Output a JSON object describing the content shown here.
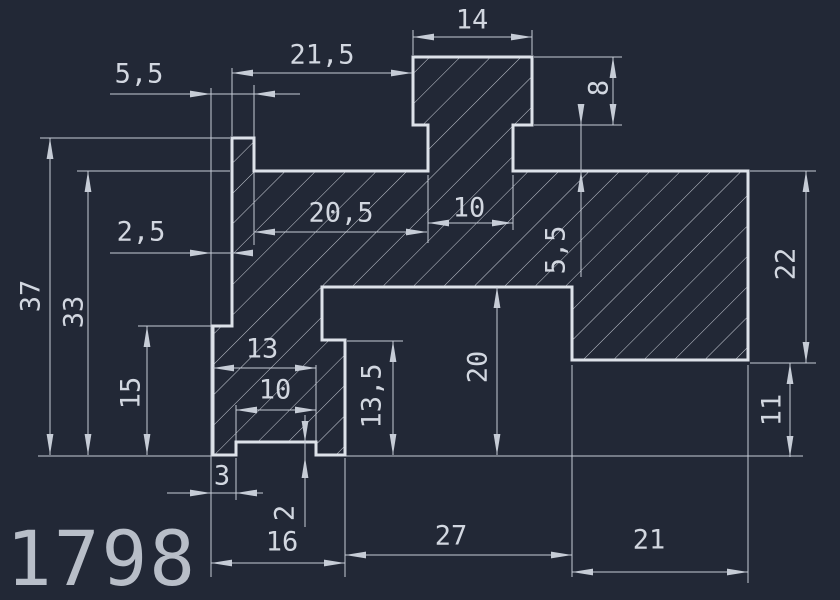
{
  "app": {
    "viewport_label": "CAD model space",
    "background_color": "#222836"
  },
  "style": {
    "outline_color": "#dde2e9",
    "thin_color": "#c6ccd6",
    "hatch_color": "#c9ced7",
    "text_color": "#d2d7e0",
    "number_color": "#b8bec8",
    "outline_width": 3,
    "thin_width": 1,
    "hatch_spacing": 21.5,
    "arrow_len": 21,
    "arrow_halfwidth": 3.4,
    "dim_font_size": 27,
    "number_font_size": 76
  },
  "part": {
    "name": "section-profile",
    "outline": [
      [
        232,
        138
      ],
      [
        254,
        138
      ],
      [
        254,
        171
      ],
      [
        428,
        171
      ],
      [
        428,
        125
      ],
      [
        413,
        125
      ],
      [
        413,
        57
      ],
      [
        532,
        57
      ],
      [
        532,
        125
      ],
      [
        513,
        125
      ],
      [
        513,
        171
      ],
      [
        748,
        171
      ],
      [
        748,
        360
      ],
      [
        572,
        360
      ],
      [
        572,
        287
      ],
      [
        322,
        287
      ],
      [
        322,
        340
      ],
      [
        345,
        340
      ],
      [
        345,
        455
      ],
      [
        316,
        455
      ],
      [
        316,
        442
      ],
      [
        236,
        442
      ],
      [
        236,
        455
      ],
      [
        213,
        455
      ],
      [
        213,
        326
      ],
      [
        232,
        326
      ]
    ]
  },
  "ref_lines": [
    [
      40,
      138,
      230,
      138
    ],
    [
      77,
      171,
      230,
      171
    ],
    [
      138,
      326,
      211,
      326
    ],
    [
      38,
      456,
      211,
      456
    ],
    [
      345,
      456,
      803,
      456
    ],
    [
      211,
      88,
      211,
      577
    ],
    [
      254,
      85,
      254,
      245
    ],
    [
      232,
      68,
      232,
      136
    ],
    [
      413,
      30,
      413,
      55
    ],
    [
      532,
      30,
      532,
      55
    ],
    [
      534,
      57,
      622,
      57
    ],
    [
      534,
      125,
      622,
      125
    ],
    [
      750,
      171,
      816,
      171
    ],
    [
      750,
      363,
      816,
      363
    ],
    [
      428,
      175,
      428,
      243
    ],
    [
      513,
      175,
      513,
      230
    ],
    [
      347,
      341,
      403,
      341
    ],
    [
      316,
      365,
      316,
      442
    ],
    [
      236,
      405,
      236,
      442
    ],
    [
      236,
      458,
      236,
      500
    ],
    [
      345,
      458,
      345,
      577
    ],
    [
      572,
      365,
      572,
      577
    ],
    [
      748,
      365,
      748,
      583
    ]
  ],
  "dimensions": [
    {
      "label": "14",
      "line": [
        413,
        37,
        532,
        37
      ],
      "arrows": [
        [
          413,
          37,
          "-x"
        ],
        [
          532,
          37,
          "+x"
        ]
      ],
      "text": [
        472,
        20,
        0
      ]
    },
    {
      "label": "21,5",
      "line": [
        232,
        73,
        412,
        73
      ],
      "arrows": [
        [
          232,
          73,
          "-x"
        ],
        [
          412,
          73,
          "+x"
        ]
      ],
      "text": [
        322,
        55,
        0
      ]
    },
    {
      "label": "5,5",
      "line": [
        110,
        94,
        300,
        94
      ],
      "arrows": [
        [
          211,
          94,
          "+x"
        ],
        [
          254,
          94,
          "-x"
        ]
      ],
      "text": [
        139,
        74,
        0
      ]
    },
    {
      "label": "2,5",
      "line": [
        110,
        253,
        253,
        253
      ],
      "arrows": [
        [
          211,
          253,
          "+x"
        ],
        [
          232,
          253,
          "-x"
        ]
      ],
      "text": [
        141,
        232,
        0
      ]
    },
    {
      "label": "20,5",
      "line": [
        254,
        232,
        427,
        232
      ],
      "arrows": [
        [
          254,
          232,
          "-x"
        ],
        [
          427,
          232,
          "+x"
        ]
      ],
      "text": [
        341,
        213,
        0
      ]
    },
    {
      "label": "10",
      "line": [
        428,
        223,
        513,
        223
      ],
      "arrows": [
        [
          428,
          223,
          "-x"
        ],
        [
          513,
          223,
          "+x"
        ]
      ],
      "text": [
        469,
        208,
        0
      ]
    },
    {
      "label": "8",
      "line": [
        613,
        57,
        613,
        125
      ],
      "arrows": [
        [
          613,
          57,
          "-y"
        ],
        [
          613,
          125,
          "+y"
        ]
      ],
      "text": [
        599,
        88,
        -90
      ]
    },
    {
      "label": "5,5",
      "line": [
        581,
        105,
        581,
        277
      ],
      "arrows": [
        [
          581,
          125,
          "+y"
        ],
        [
          581,
          171,
          "-y"
        ]
      ],
      "text": [
        556,
        250,
        -90
      ]
    },
    {
      "label": "22",
      "line": [
        806,
        171,
        806,
        363
      ],
      "arrows": [
        [
          806,
          171,
          "-y"
        ],
        [
          806,
          363,
          "+y"
        ]
      ],
      "text": [
        786,
        264,
        -90
      ]
    },
    {
      "label": "37",
      "line": [
        50,
        138,
        50,
        455
      ],
      "arrows": [
        [
          50,
          138,
          "-y"
        ],
        [
          50,
          455,
          "+y"
        ]
      ],
      "text": [
        31,
        296,
        -90
      ]
    },
    {
      "label": "33",
      "line": [
        88,
        171,
        88,
        455
      ],
      "arrows": [
        [
          88,
          171,
          "-y"
        ],
        [
          88,
          455,
          "+y"
        ]
      ],
      "text": [
        74,
        312,
        -90
      ]
    },
    {
      "label": "15",
      "line": [
        147,
        326,
        147,
        455
      ],
      "arrows": [
        [
          147,
          326,
          "-y"
        ],
        [
          147,
          455,
          "+y"
        ]
      ],
      "text": [
        131,
        393,
        -90
      ]
    },
    {
      "label": "13",
      "line": [
        213,
        368,
        316,
        368
      ],
      "arrows": [
        [
          213,
          368,
          "-x"
        ],
        [
          316,
          368,
          "+x"
        ]
      ],
      "text": [
        262,
        349,
        0
      ]
    },
    {
      "label": "10",
      "line": [
        236,
        410,
        316,
        410
      ],
      "arrows": [
        [
          236,
          410,
          "-x"
        ],
        [
          316,
          410,
          "+x"
        ]
      ],
      "text": [
        275,
        390,
        0
      ]
    },
    {
      "label": "13,5",
      "line": [
        393,
        341,
        393,
        455
      ],
      "arrows": [
        [
          393,
          341,
          "-y"
        ],
        [
          393,
          455,
          "+y"
        ]
      ],
      "text": [
        372,
        396,
        -90
      ]
    },
    {
      "label": "20",
      "line": [
        497,
        287,
        497,
        455
      ],
      "arrows": [
        [
          497,
          287,
          "-y"
        ],
        [
          497,
          455,
          "+y"
        ]
      ],
      "text": [
        478,
        367,
        -90
      ]
    },
    {
      "label": "11",
      "line": [
        790,
        363,
        790,
        457
      ],
      "arrows": [
        [
          790,
          363,
          "-y"
        ],
        [
          790,
          457,
          "+y"
        ]
      ],
      "text": [
        772,
        410,
        -90
      ]
    },
    {
      "label": "3",
      "line": [
        167,
        493,
        263,
        493
      ],
      "arrows": [
        [
          211,
          493,
          "+x"
        ],
        [
          236,
          493,
          "-x"
        ]
      ],
      "text": [
        222,
        476,
        0
      ]
    },
    {
      "label": "2",
      "line": [
        305,
        415,
        305,
        527
      ],
      "arrows": [
        [
          305,
          442,
          "+y"
        ],
        [
          305,
          457,
          "-y"
        ]
      ],
      "text": [
        285,
        513,
        -90
      ]
    },
    {
      "label": "16",
      "line": [
        211,
        563,
        345,
        563
      ],
      "arrows": [
        [
          211,
          563,
          "-x"
        ],
        [
          345,
          563,
          "+x"
        ]
      ],
      "text": [
        282,
        542,
        0
      ]
    },
    {
      "label": "27",
      "line": [
        345,
        555,
        572,
        555
      ],
      "arrows": [
        [
          345,
          555,
          "-x"
        ],
        [
          572,
          555,
          "+x"
        ]
      ],
      "text": [
        451,
        536,
        0
      ]
    },
    {
      "label": "21",
      "line": [
        572,
        572,
        748,
        572
      ],
      "arrows": [
        [
          572,
          572,
          "-x"
        ],
        [
          748,
          572,
          "+x"
        ]
      ],
      "text": [
        649,
        540,
        0
      ]
    }
  ],
  "drawing_number": {
    "text": "1798",
    "x": 6,
    "y": 585
  }
}
